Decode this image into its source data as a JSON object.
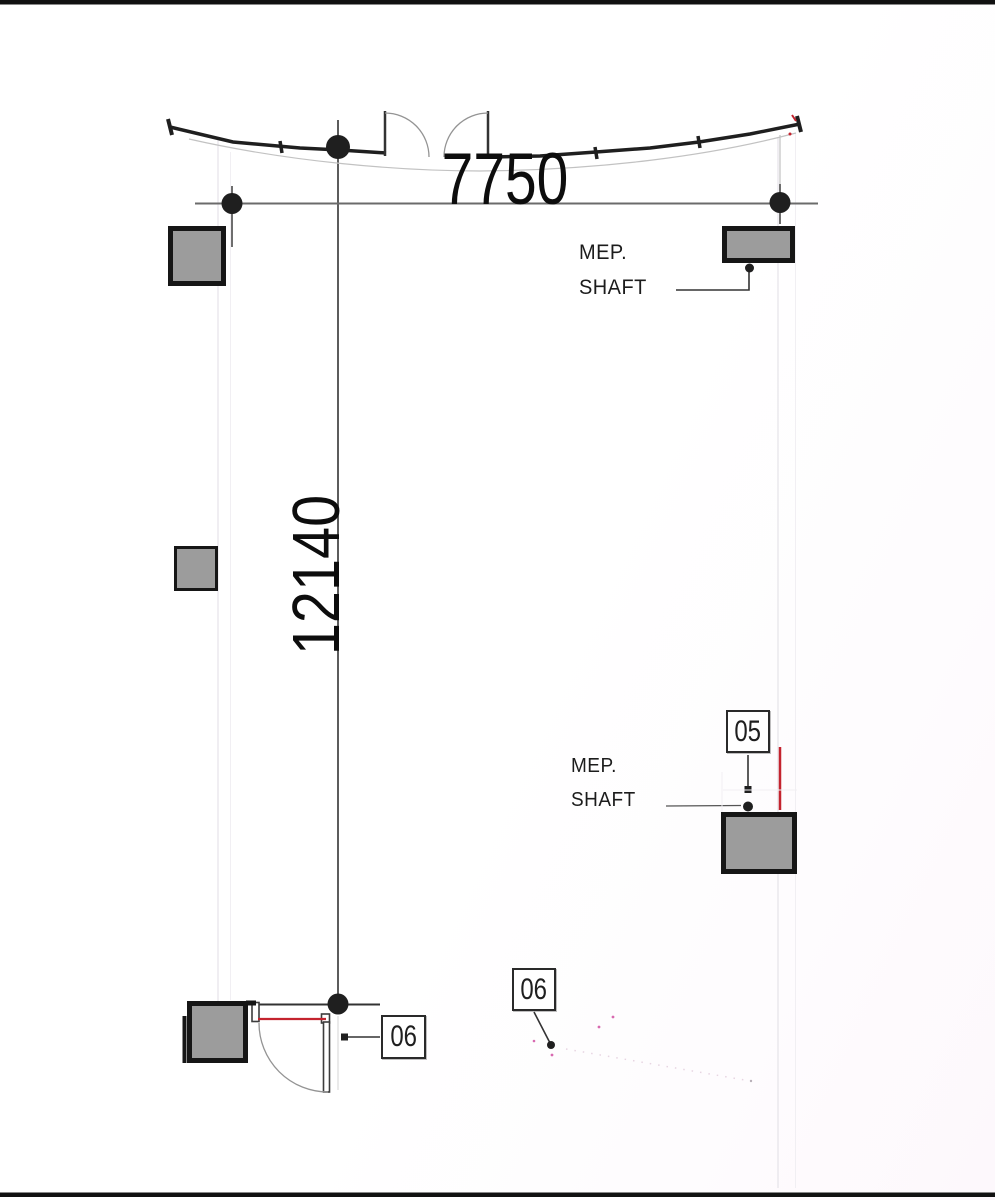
{
  "drawing": {
    "dim_horizontal": "7750",
    "dim_vertical": "12140",
    "mep_shaft_top": {
      "line1": "MEP.",
      "line2": "SHAFT"
    },
    "mep_shaft_bottom": {
      "line1": "MEP.",
      "line2": "SHAFT"
    },
    "tags": {
      "shaft_05": "05",
      "door_06_left": "06",
      "door_06_mid": "06"
    },
    "icons": {
      "grid_bubble": "filled-circle-grid-marker",
      "leader_dot": "filled-circle-leader-end",
      "leader_square": "filled-square-leader-end"
    },
    "colors": {
      "ink": "#1f1f1f",
      "grid_line": "#4a4a4a",
      "dim_line": "#6b6b6b",
      "faint_line": "#e9e7ec",
      "faint_line_2": "#f1eff3",
      "faint_grid": "#dcdcdc",
      "wall_thin": "#c2c2c2",
      "arc_gray": "#949494",
      "leader": "#333333",
      "column_fill": "#9c9c9c",
      "column_border": "#161616",
      "tag_border": "#2a2a2a",
      "red_accent": "#c4232e",
      "magenta_speck": "#d86ab0",
      "frame_bar": "#111111",
      "background": "#ffffff"
    }
  }
}
